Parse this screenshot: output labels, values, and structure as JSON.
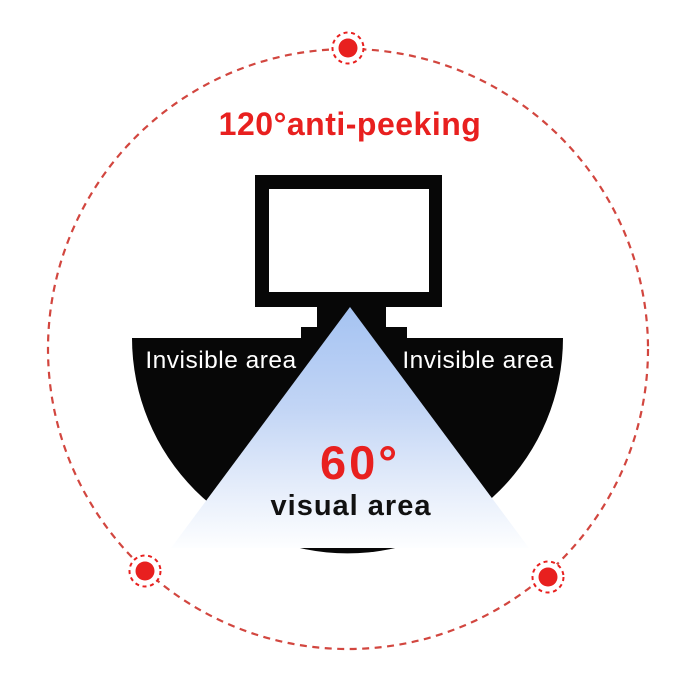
{
  "title": {
    "text": "120°anti-peeking"
  },
  "diagram": {
    "left_wedge_label": "Invisible area",
    "right_wedge_label": "Invisible area",
    "cone_angle_label": "60°",
    "cone_area_label": "visual area",
    "viewer_dot_count": 3
  },
  "icons": {
    "monitor": "monitor-icon",
    "viewer_dot": "viewer-position-dot"
  },
  "colors": {
    "accent_red": "#e8201f",
    "dashed_circle_red": "#d2463f",
    "wedge_black": "#070707",
    "cone_blue_top": "#a5c3f2",
    "cone_blue_mid": "#c2d5f5",
    "cone_blue_low": "#e8effb",
    "cone_blue_bottom": "#fdfeff",
    "label_white": "#ffffff",
    "visual_label_black": "#111111",
    "screen_white": "#ffffff"
  }
}
